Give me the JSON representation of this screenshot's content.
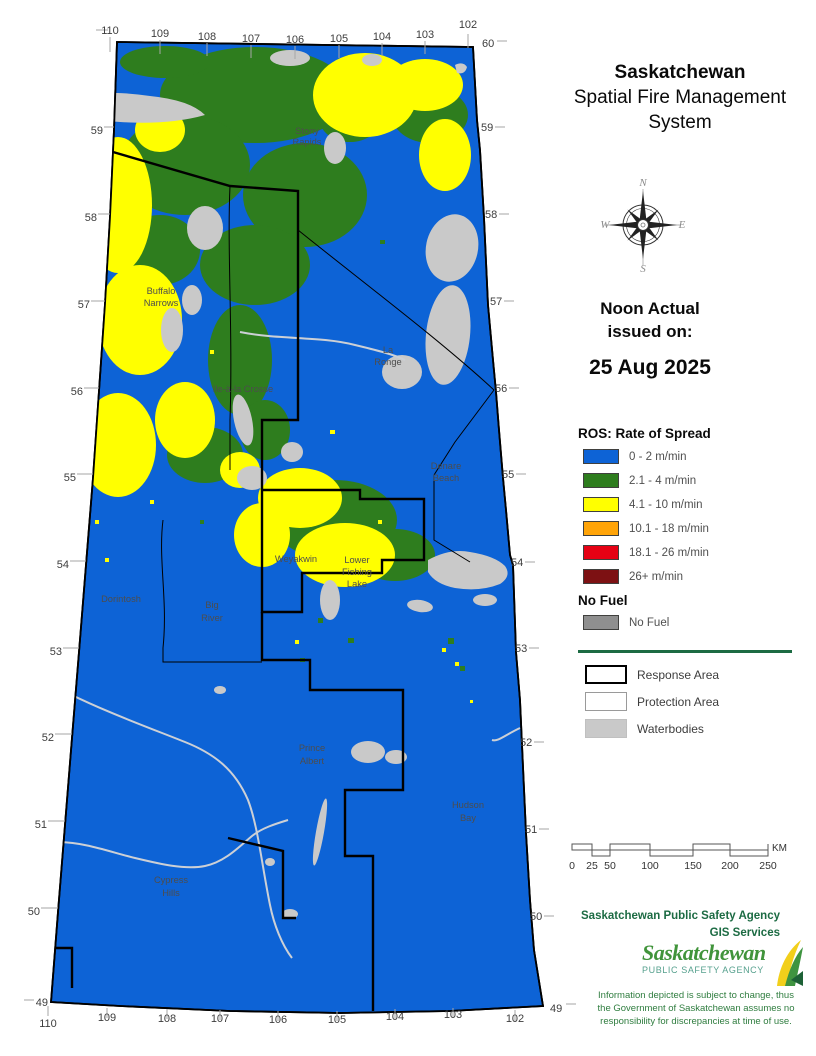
{
  "title": {
    "line1": "Saskatchewan",
    "line2": "Spatial Fire Management",
    "line3": "System"
  },
  "compass": {
    "n": "N",
    "e": "E",
    "s": "S",
    "w": "W"
  },
  "issued": {
    "line1": "Noon Actual",
    "line2": "issued on:",
    "date": "25 Aug 2025"
  },
  "legend": {
    "ros_header": "ROS: Rate of Spread",
    "items": [
      {
        "label": "0 - 2 m/min",
        "color": "#0d63d6"
      },
      {
        "label": "2.1 - 4 m/min",
        "color": "#2e7d1e"
      },
      {
        "label": "4.1 - 10 m/min",
        "color": "#ffff00"
      },
      {
        "label": "10.1 - 18 m/min",
        "color": "#ffa408"
      },
      {
        "label": "18.1 - 26 m/min",
        "color": "#e60114"
      },
      {
        "label": "26+ m/min",
        "color": "#7d1113"
      }
    ],
    "no_fuel_header": "No Fuel",
    "no_fuel_label": "No Fuel",
    "no_fuel_color": "#8f8f8f",
    "areas": [
      {
        "label": "Response Area"
      },
      {
        "label": "Protection Area"
      },
      {
        "label": "Waterbodies",
        "color": "#c9c9c9"
      }
    ]
  },
  "scalebar": {
    "ticks": [
      "0",
      "25",
      "50",
      "100",
      "150",
      "200",
      "250"
    ],
    "unit": "KM"
  },
  "credits": {
    "agency": "Saskatchewan Public Safety Agency",
    "dept": "GIS  Services"
  },
  "logo": {
    "name": "Saskatchewan",
    "sub": "PUBLIC SAFETY AGENCY"
  },
  "disclaimer": {
    "line1": "Information depicted is subject to change, thus",
    "line2": "the Government of Saskatchewan assumes no",
    "line3": "responsibility for discrepancies at time of use."
  },
  "map": {
    "colors": {
      "base_blue": "#0d63d6",
      "forest_green": "#2e7d1e",
      "ros_yellow": "#ffff00",
      "waterbody_gray": "#c9c9c9",
      "boundary_black": "#000000"
    },
    "lon_top": [
      "110",
      "109",
      "108",
      "107",
      "106",
      "105",
      "104",
      "103",
      "102"
    ],
    "lon_bottom": [
      "110",
      "109",
      "108",
      "107",
      "106",
      "105",
      "104",
      "103",
      "102"
    ],
    "lat_left": [
      "59",
      "58",
      "57",
      "56",
      "55",
      "54",
      "53",
      "52",
      "51",
      "50",
      "49"
    ],
    "lat_right": [
      "60",
      "59",
      "58",
      "57",
      "56",
      "55",
      "54",
      "53",
      "52",
      "51",
      "50",
      "49"
    ],
    "places": {
      "stony_rapids": {
        "l1": "Stony",
        "l2": "Rapids"
      },
      "buffalo_narrows": {
        "l1": "Buffalo",
        "l2": "Narrows"
      },
      "ile_a_la_crosse": {
        "l1": "Ile-à-la Crosse"
      },
      "la_ronge": {
        "l1": "La",
        "l2": "Ronge"
      },
      "denare_beach": {
        "l1": "Denare",
        "l2": "Beach"
      },
      "weyakwin": {
        "l1": "Weyakwin"
      },
      "lower_fishing_lake": {
        "l1": "Lower",
        "l2": "Fishing",
        "l3": "Lake"
      },
      "dorintosh": {
        "l1": "Dorintosh"
      },
      "big_river": {
        "l1": "Big",
        "l2": "River"
      },
      "prince_albert": {
        "l1": "Prince",
        "l2": "Albert"
      },
      "hudson_bay": {
        "l1": "Hudson",
        "l2": "Bay"
      },
      "cypress_hills": {
        "l1": "Cypress",
        "l2": "Hills"
      }
    }
  }
}
